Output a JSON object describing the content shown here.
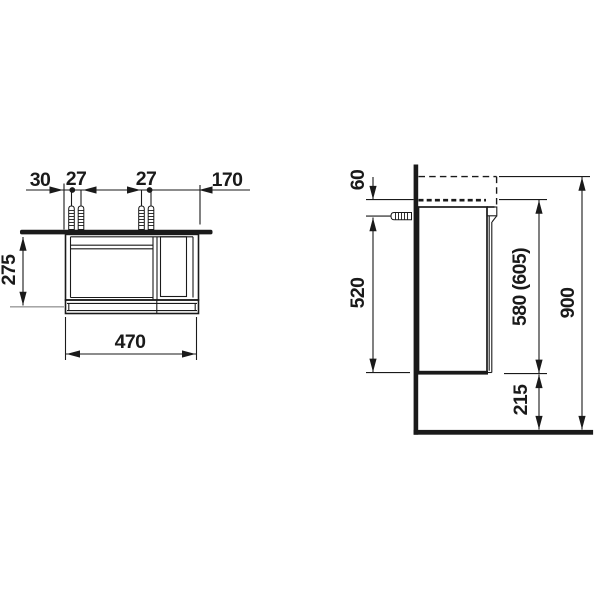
{
  "drawing_type": "technical dimension drawing (wall-hung vanity unit, front and side view)",
  "front_view": {
    "top_dimensions": {
      "edge_offset": "30",
      "screw_pair_left_spacing": "27",
      "screw_pair_right_spacing": "27",
      "screw_to_right_edge": "170"
    },
    "height_dimension": "275",
    "width_dimension": "470"
  },
  "side_view": {
    "basin_to_screw": "60",
    "screw_to_cabinet_bottom": "520",
    "cabinet_height": "580 (605)",
    "overall_height": "900",
    "floor_clearance": "215"
  },
  "colors": {
    "line": "#1a1a1a",
    "background": "#ffffff",
    "extension_line_gray": "#9a9a9a"
  }
}
